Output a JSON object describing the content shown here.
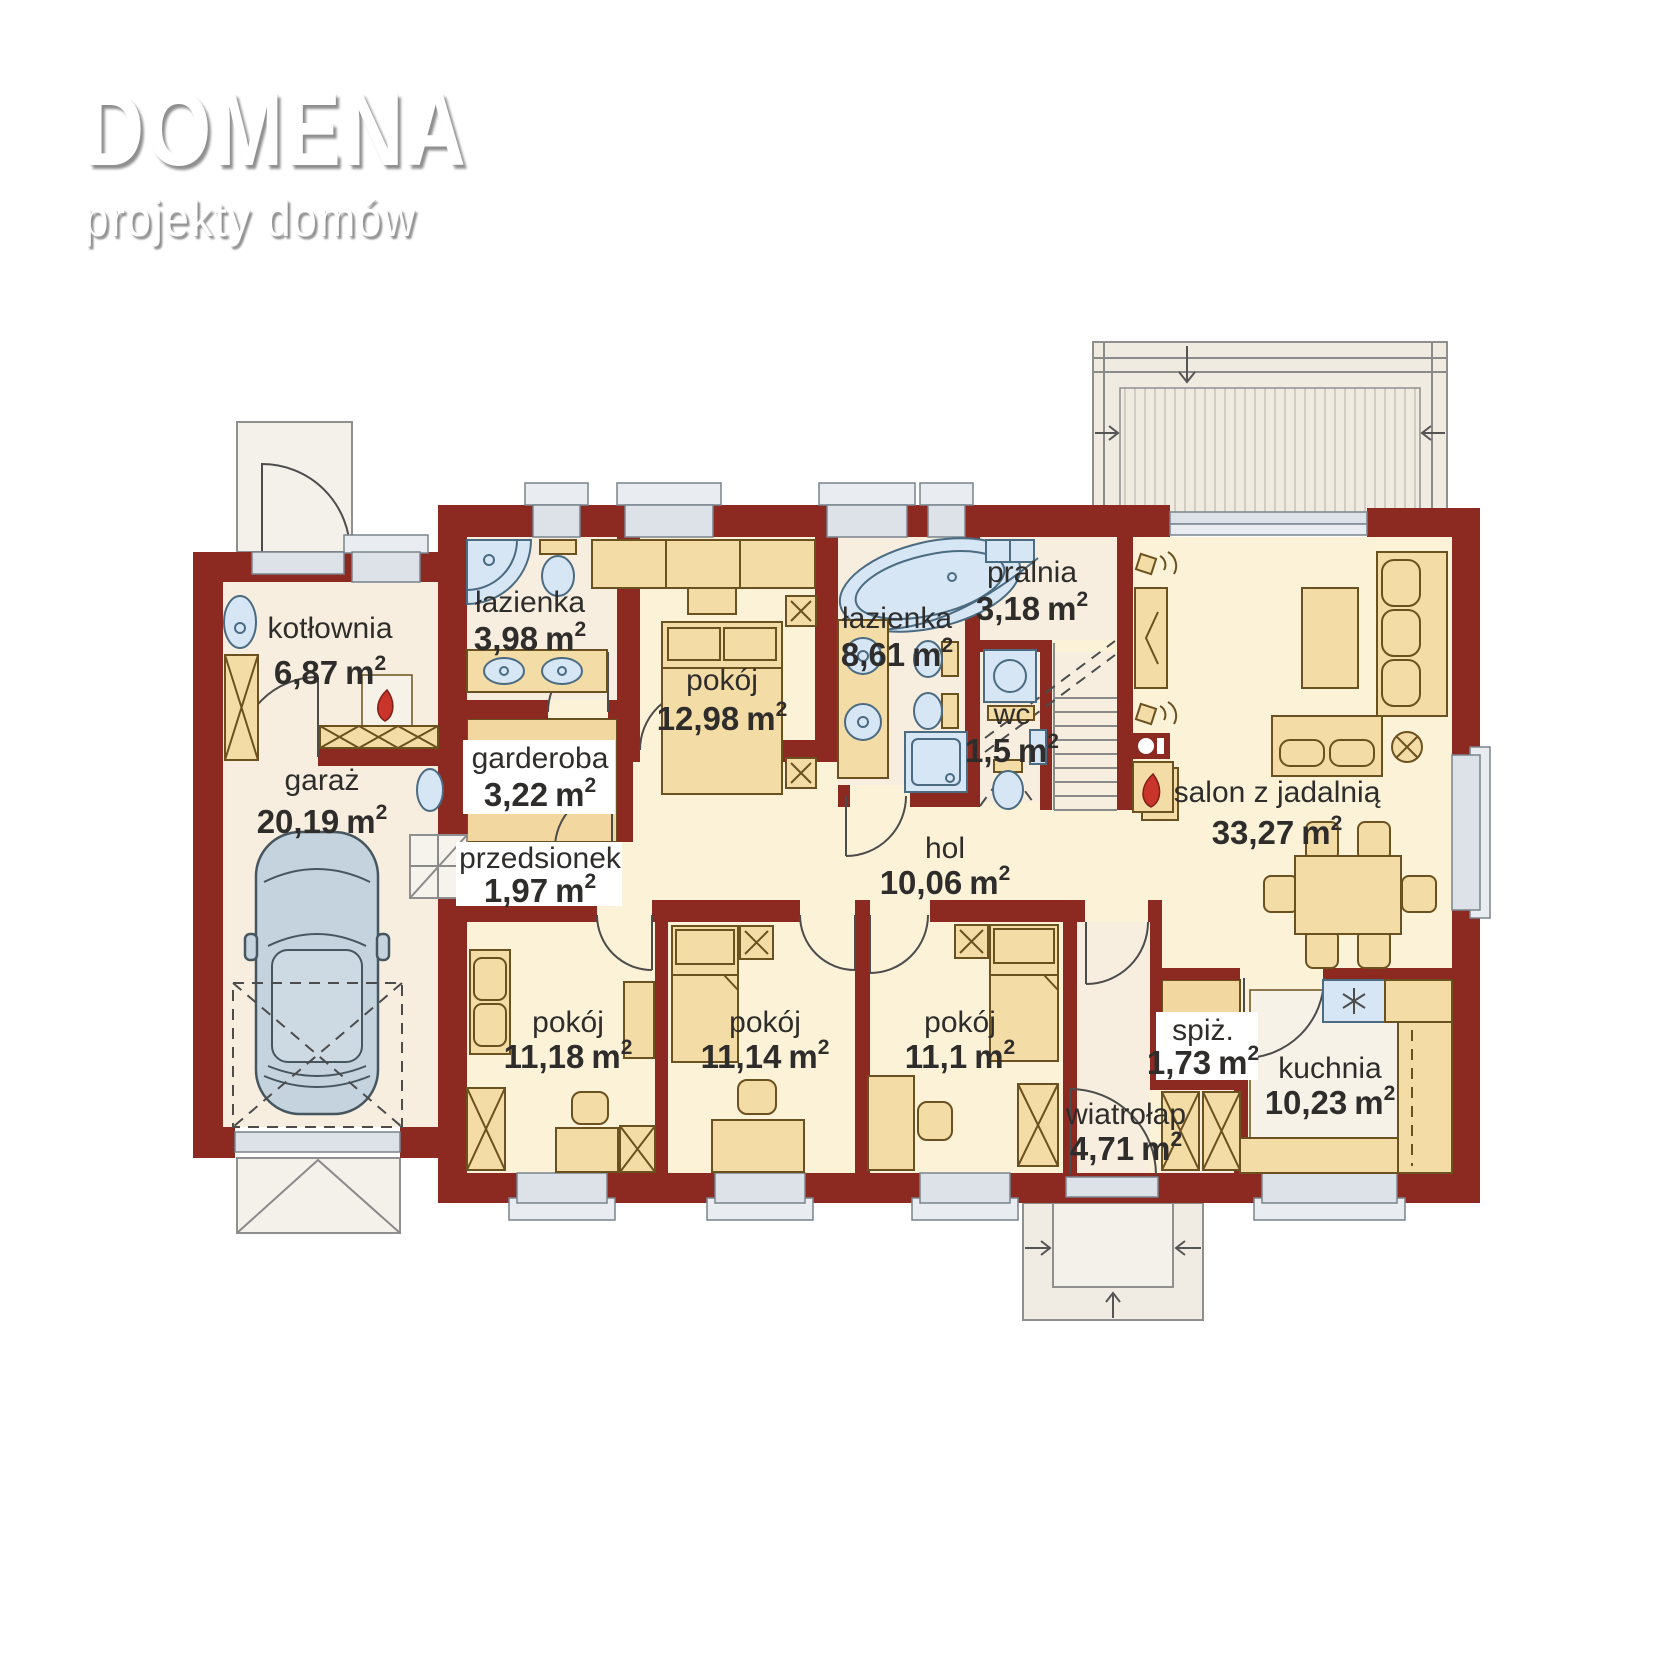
{
  "logo": {
    "title": "DOMENA",
    "subtitle": "projekty domów"
  },
  "units": {
    "m": "m",
    "sup": "2"
  },
  "rooms": [
    {
      "name": "kotłownia",
      "area": "6,87"
    },
    {
      "name": "garaż",
      "area": "20,19"
    },
    {
      "name": "łazienka",
      "area": "3,98"
    },
    {
      "name": "garderoba",
      "area": "3,22"
    },
    {
      "name": "pokój",
      "area": "12,98"
    },
    {
      "name": "łazienka",
      "area": "8,61"
    },
    {
      "name": "pralnia",
      "area": "3,18"
    },
    {
      "name": "wc",
      "area": "1,5"
    },
    {
      "name": "salon z jadalnią",
      "area": "33,27"
    },
    {
      "name": "przedsionek",
      "area": "1,97"
    },
    {
      "name": "hol",
      "area": "10,06"
    },
    {
      "name": "pokój",
      "area": "11,18"
    },
    {
      "name": "pokój",
      "area": "11,14"
    },
    {
      "name": "pokój",
      "area": "11,1"
    },
    {
      "name": "wiatrołap",
      "area": "4,71"
    },
    {
      "name": "spiż.",
      "area": "1,73"
    },
    {
      "name": "kuchnia",
      "area": "10,23"
    }
  ],
  "colors": {
    "wall": "#8c2a22",
    "floor_utility": "#f7eedf",
    "floor_living": "#fbf2d8",
    "wardrobe_floor": "#f2d8a0",
    "furniture": "#f3dca6",
    "fixtures": "#d6e6f4",
    "window": "#dce2e8",
    "flame": "#c9342b",
    "car": "#c5d3df",
    "terrace": "#efebe1",
    "text": "#2f2d2b"
  }
}
